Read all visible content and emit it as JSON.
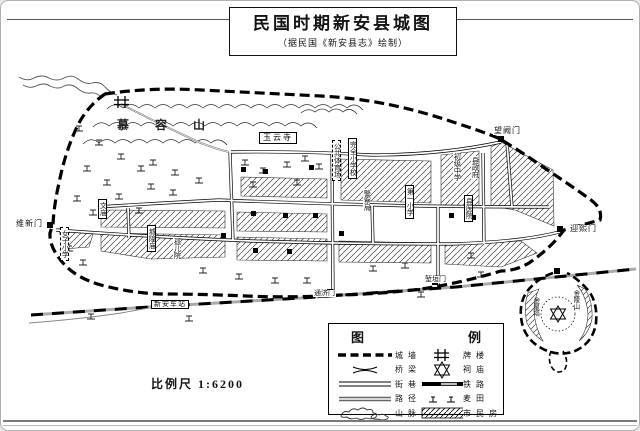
{
  "title": {
    "main": "民国时期新安县城图",
    "sub": "（据民国《新安县志》绘制）"
  },
  "scale": {
    "label": "比例尺 1:6200"
  },
  "colors": {
    "ink": "#141414",
    "paper": "#ffffff",
    "railway_gray": "#bbbbbb"
  },
  "legend": {
    "title_left": "图",
    "title_right": "例",
    "left": [
      {
        "symbol": "city-wall",
        "label": "城墙"
      },
      {
        "symbol": "bridge",
        "label": "桥梁"
      },
      {
        "symbol": "street",
        "label": "街巷"
      },
      {
        "symbol": "path",
        "label": "路径"
      },
      {
        "symbol": "mountain",
        "label": "山脉"
      }
    ],
    "right": [
      {
        "symbol": "archway",
        "label": "牌楼"
      },
      {
        "symbol": "temple",
        "label": "祠庙"
      },
      {
        "symbol": "railway",
        "label": "铁路"
      },
      {
        "symbol": "field",
        "label": "麦田"
      },
      {
        "symbol": "housing",
        "label": "市民房"
      }
    ]
  },
  "map": {
    "labels": [
      {
        "text": "慕容山",
        "x": 116,
        "y": 118,
        "kind": "spread"
      },
      {
        "text": "玉云寺",
        "x": 258,
        "y": 131,
        "kind": "box"
      },
      {
        "text": "公共体育场",
        "x": 331,
        "y": 139,
        "kind": "vdash"
      },
      {
        "text": "完全小学校",
        "x": 347,
        "y": 137,
        "kind": "vbox"
      },
      {
        "text": "初级中学",
        "x": 452,
        "y": 151,
        "kind": "vtext"
      },
      {
        "text": "县政府",
        "x": 470,
        "y": 155,
        "kind": "vtext"
      },
      {
        "text": "第一小学",
        "x": 404,
        "y": 184,
        "kind": "vbox"
      },
      {
        "text": "县医院",
        "x": 463,
        "y": 194,
        "kind": "vbox"
      },
      {
        "text": "警察局",
        "x": 362,
        "y": 188,
        "kind": "vtext"
      },
      {
        "text": "城隍庙",
        "x": 146,
        "y": 224,
        "kind": "vbox"
      },
      {
        "text": "孤儿院",
        "x": 172,
        "y": 236,
        "kind": "vtext"
      },
      {
        "text": "文庙",
        "x": 97,
        "y": 198,
        "kind": "vbox"
      },
      {
        "text": "女子小学",
        "x": 59,
        "y": 226,
        "kind": "vdash"
      },
      {
        "text": "维新门",
        "x": 14,
        "y": 219,
        "kind": "gate"
      },
      {
        "text": "迎熙门",
        "x": 568,
        "y": 224,
        "kind": "gate"
      },
      {
        "text": "望阙门",
        "x": 492,
        "y": 126,
        "kind": "gate"
      },
      {
        "text": "通济门",
        "x": 312,
        "y": 289,
        "kind": "gate-sm"
      },
      {
        "text": "堑垣门",
        "x": 423,
        "y": 275,
        "kind": "gate-sm"
      },
      {
        "text": "新安车站",
        "x": 150,
        "y": 299,
        "kind": "box-sm"
      },
      {
        "text": "金陵山",
        "x": 570,
        "y": 289,
        "kind": "vtext-sm"
      },
      {
        "text": "金星塔",
        "x": 530,
        "y": 296,
        "kind": "vtext-sm"
      }
    ]
  }
}
